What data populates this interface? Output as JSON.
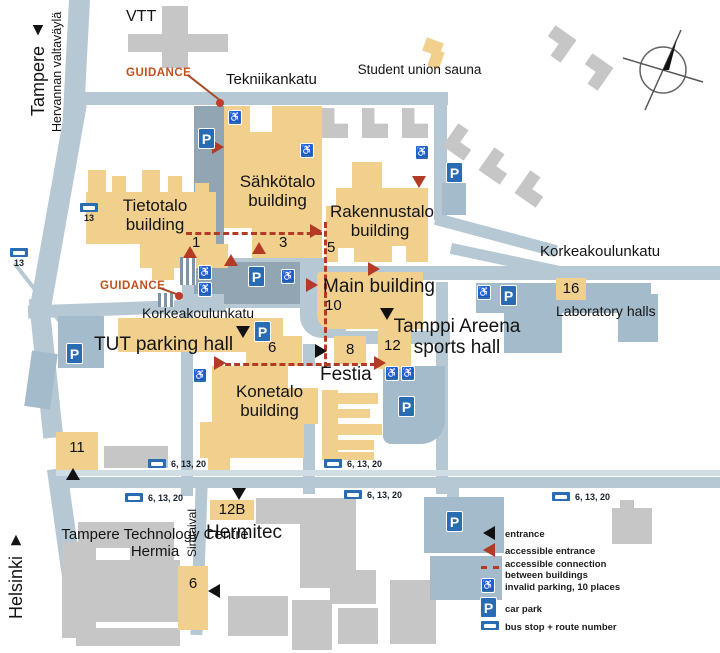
{
  "directions": {
    "tampere": "Tampere ▲",
    "hervannan": "Hervannan valtaväylä",
    "helsinki": "Helsinki ▼"
  },
  "streets": {
    "tekniikankatu": "Tekniikankatu",
    "korkeakoulunkatu": "Korkeakoulunkatu",
    "sinitaival": "Sinitaival"
  },
  "buildings": {
    "vtt": "VTT",
    "student_union_sauna": "Student union sauna",
    "sahkotalo": "Sähkötalo building",
    "tietotalo": "Tietotalo building",
    "rakennustalo": "Rakennustalo building",
    "main": "Main building",
    "tamppi": "Tamppi Areena sports hall",
    "laboratory": "Laboratory halls",
    "tut_parking": "TUT parking hall",
    "konetalo": "Konetalo building",
    "festia": "Festia",
    "hermitec": "Hermitec",
    "hermia": "Tampere Technology Centre Hermia"
  },
  "building_numbers": {
    "tietotalo": "1",
    "sahkotalo": "3",
    "rakennustalo": "5",
    "main": "10",
    "konetalo": "6",
    "festia": "8",
    "tamppi": "12",
    "laboratory": "16",
    "b11": "11",
    "b12b": "12B",
    "b6_south": "6"
  },
  "guidance_label": "GUIDANCE",
  "bus_routes": {
    "route_13": "13",
    "routes_6_13_20": "6, 13, 20"
  },
  "legend": {
    "entrance": "entrance",
    "accessible_entrance": "accessible entrance",
    "accessible_connection_line1": "accessible connection",
    "accessible_connection_line2": "between buildings",
    "invalid_parking": "invalid parking, 10 places",
    "car_park": "car park",
    "bus_stop": "bus stop + route number"
  },
  "icons": {
    "car_park_letter": "P",
    "wheelchair": "♿"
  },
  "colors": {
    "road": "#b5c8d3",
    "building_yellow": "#f1d08d",
    "building_gray": "#c6c6c6",
    "building_blue": "#a3bbca",
    "icon_blue": "#2a6cb3",
    "accent_red": "#b33b26",
    "guidance_orange": "#c2511c"
  }
}
